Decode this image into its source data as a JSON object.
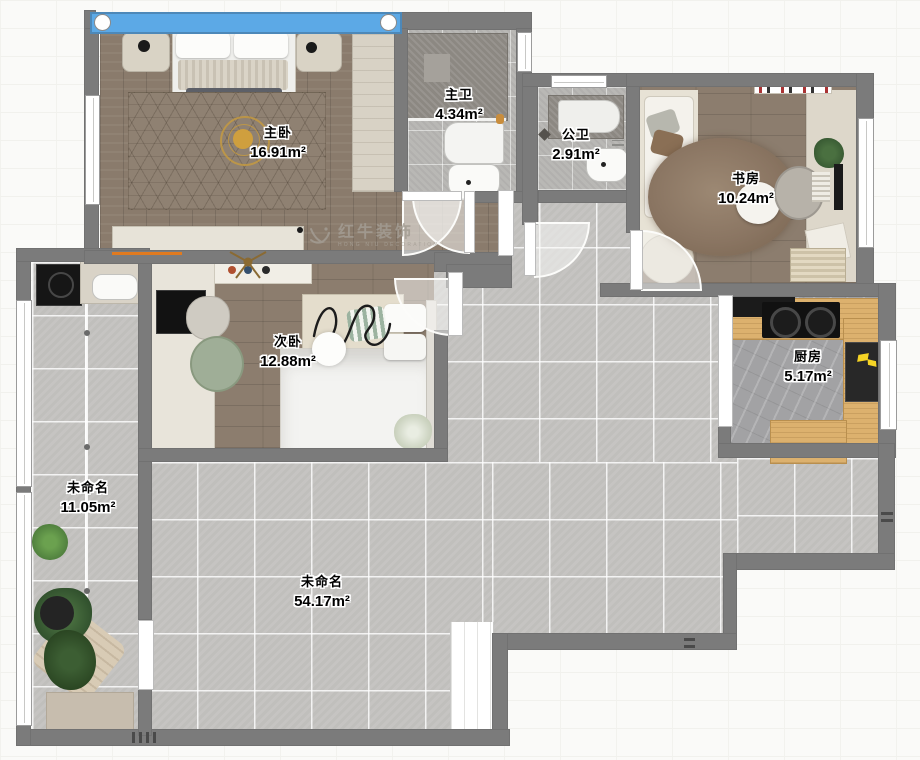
{
  "watermark": {
    "brand": "红牛装饰",
    "sub": "HONG NIU DECORATION"
  },
  "rooms": [
    {
      "id": "master-bedroom",
      "name": "主卧",
      "area": "16.91m²"
    },
    {
      "id": "master-bath",
      "name": "主卫",
      "area": "4.34m²"
    },
    {
      "id": "guest-bath",
      "name": "公卫",
      "area": "2.91m²"
    },
    {
      "id": "study",
      "name": "书房",
      "area": "10.24m²"
    },
    {
      "id": "second-bedroom",
      "name": "次卧",
      "area": "12.88m²"
    },
    {
      "id": "kitchen",
      "name": "厨房",
      "area": "5.17m²"
    },
    {
      "id": "balcony",
      "name": "未命名",
      "area": "11.05m²"
    },
    {
      "id": "living",
      "name": "未命名",
      "area": "54.17m²"
    }
  ],
  "colors": {
    "wall": "#7b7b7b",
    "window_glass": "#5ca9e6",
    "tile": "#c6c5c2",
    "wood": "#8a7b6c",
    "counter_wood": "#dcb16e",
    "accent_orange": "#e07a1f",
    "plant_green": "#3c5e33",
    "fridge_icon_yellow": "#f5d425",
    "watermark_gray": "#a39d93"
  }
}
